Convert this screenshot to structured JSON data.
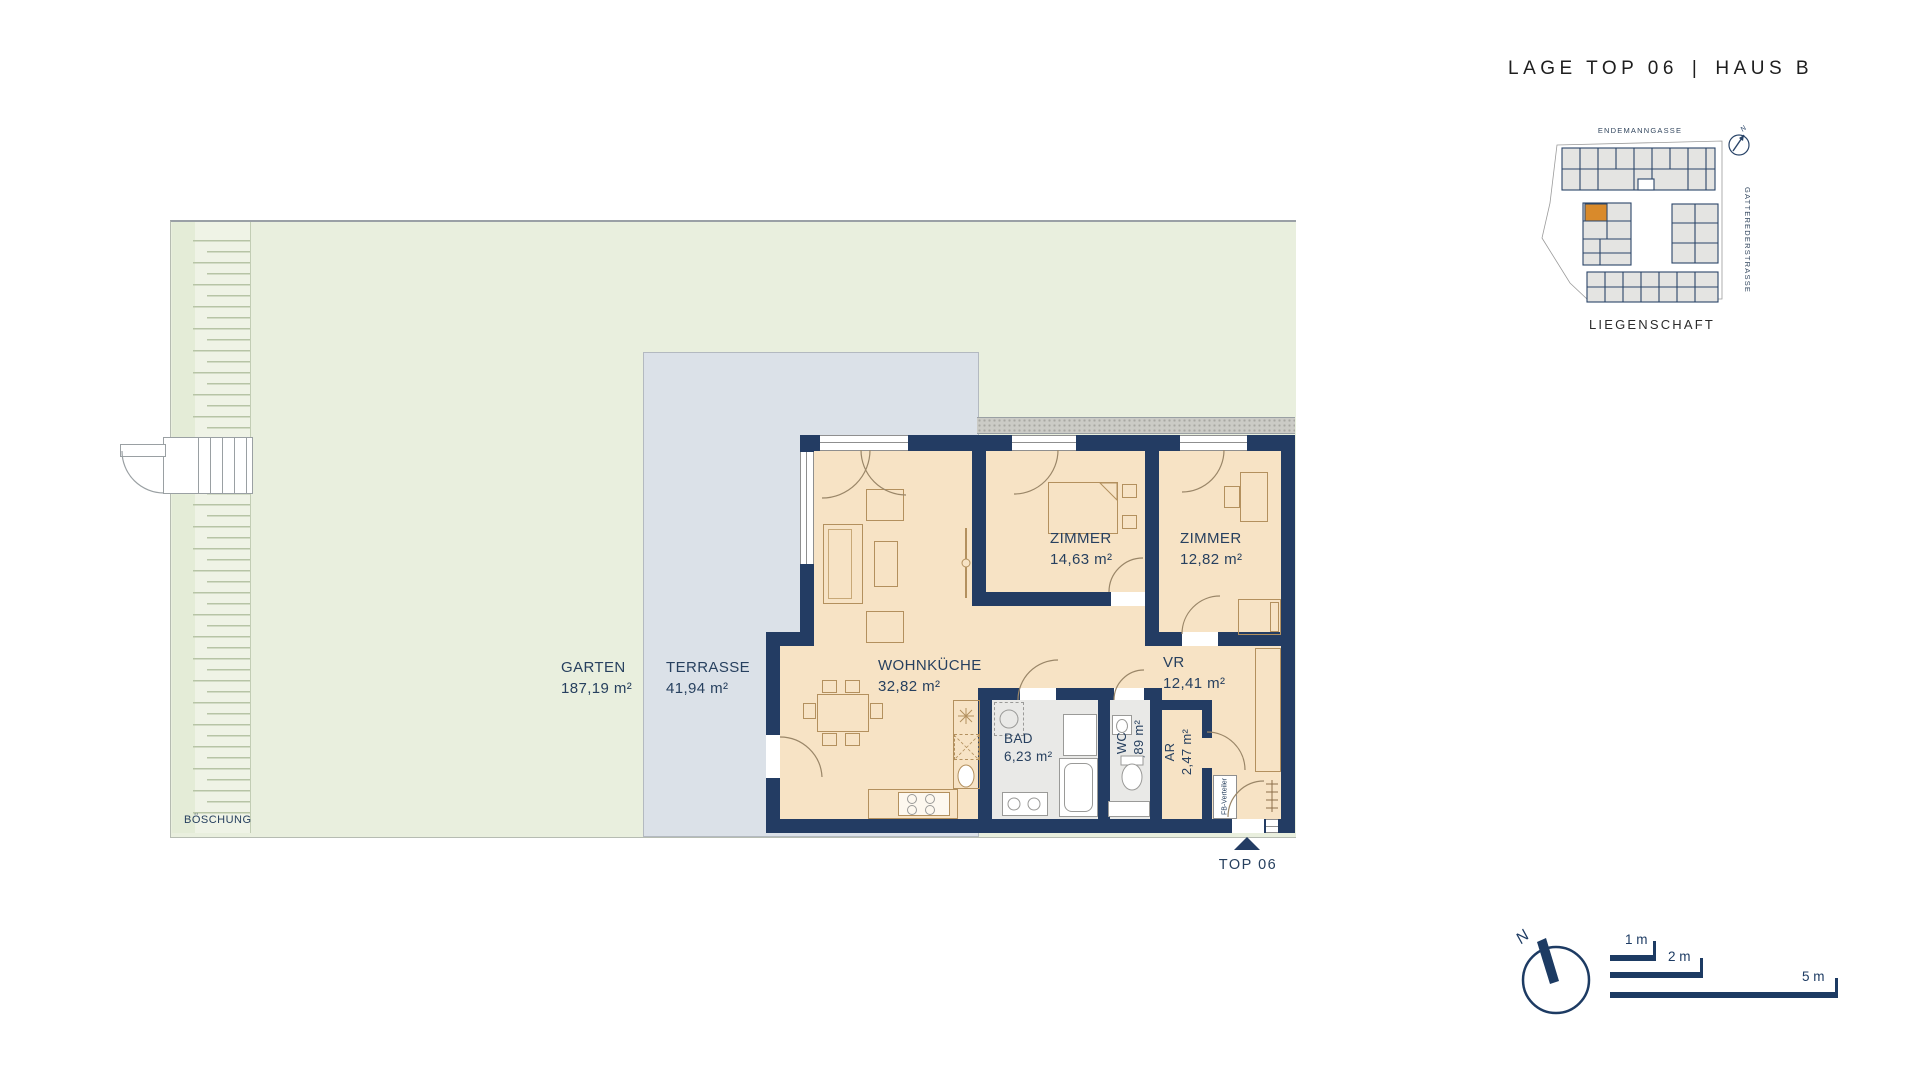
{
  "header": {
    "title_left": "LAGE TOP 06",
    "separator": "|",
    "title_right": "HAUS B"
  },
  "site_plan": {
    "street_top": "ENDEMANNGASSE",
    "street_right": "GATTEREDERSTRASSE",
    "caption": "LIEGENSCHAFT",
    "north_label": "N",
    "highlight_color": "#d98a2b"
  },
  "rooms": {
    "garten": {
      "name": "GARTEN",
      "area": "187,19 m²"
    },
    "terrasse": {
      "name": "TERRASSE",
      "area": "41,94 m²"
    },
    "wohnkueche": {
      "name": "WOHNKÜCHE",
      "area": "32,82 m²"
    },
    "zimmer1": {
      "name": "ZIMMER",
      "area": "14,63 m²"
    },
    "zimmer2": {
      "name": "ZIMMER",
      "area": "12,82 m²"
    },
    "vr": {
      "name": "VR",
      "area": "12,41 m²"
    },
    "bad": {
      "name": "BAD",
      "area": "6,23 m²"
    },
    "wc": {
      "name": "WC",
      "area": "1,89 m²"
    },
    "ar": {
      "name": "AR",
      "area": "2,47 m²"
    }
  },
  "annotations": {
    "boeschung": "BÖSCHUNG",
    "fb_verteiler": "FB-Verteiler",
    "unit_marker": "TOP 06"
  },
  "legend": {
    "north_label": "N",
    "scale_1": "1 m",
    "scale_2": "2 m",
    "scale_5": "5 m"
  },
  "colors": {
    "wall": "#233c63",
    "floor": "#f7e3c5",
    "terrace": "#dbe1e8",
    "garden": "#e9efde",
    "highlight": "#d98a2b",
    "label_text": "#27405f"
  }
}
